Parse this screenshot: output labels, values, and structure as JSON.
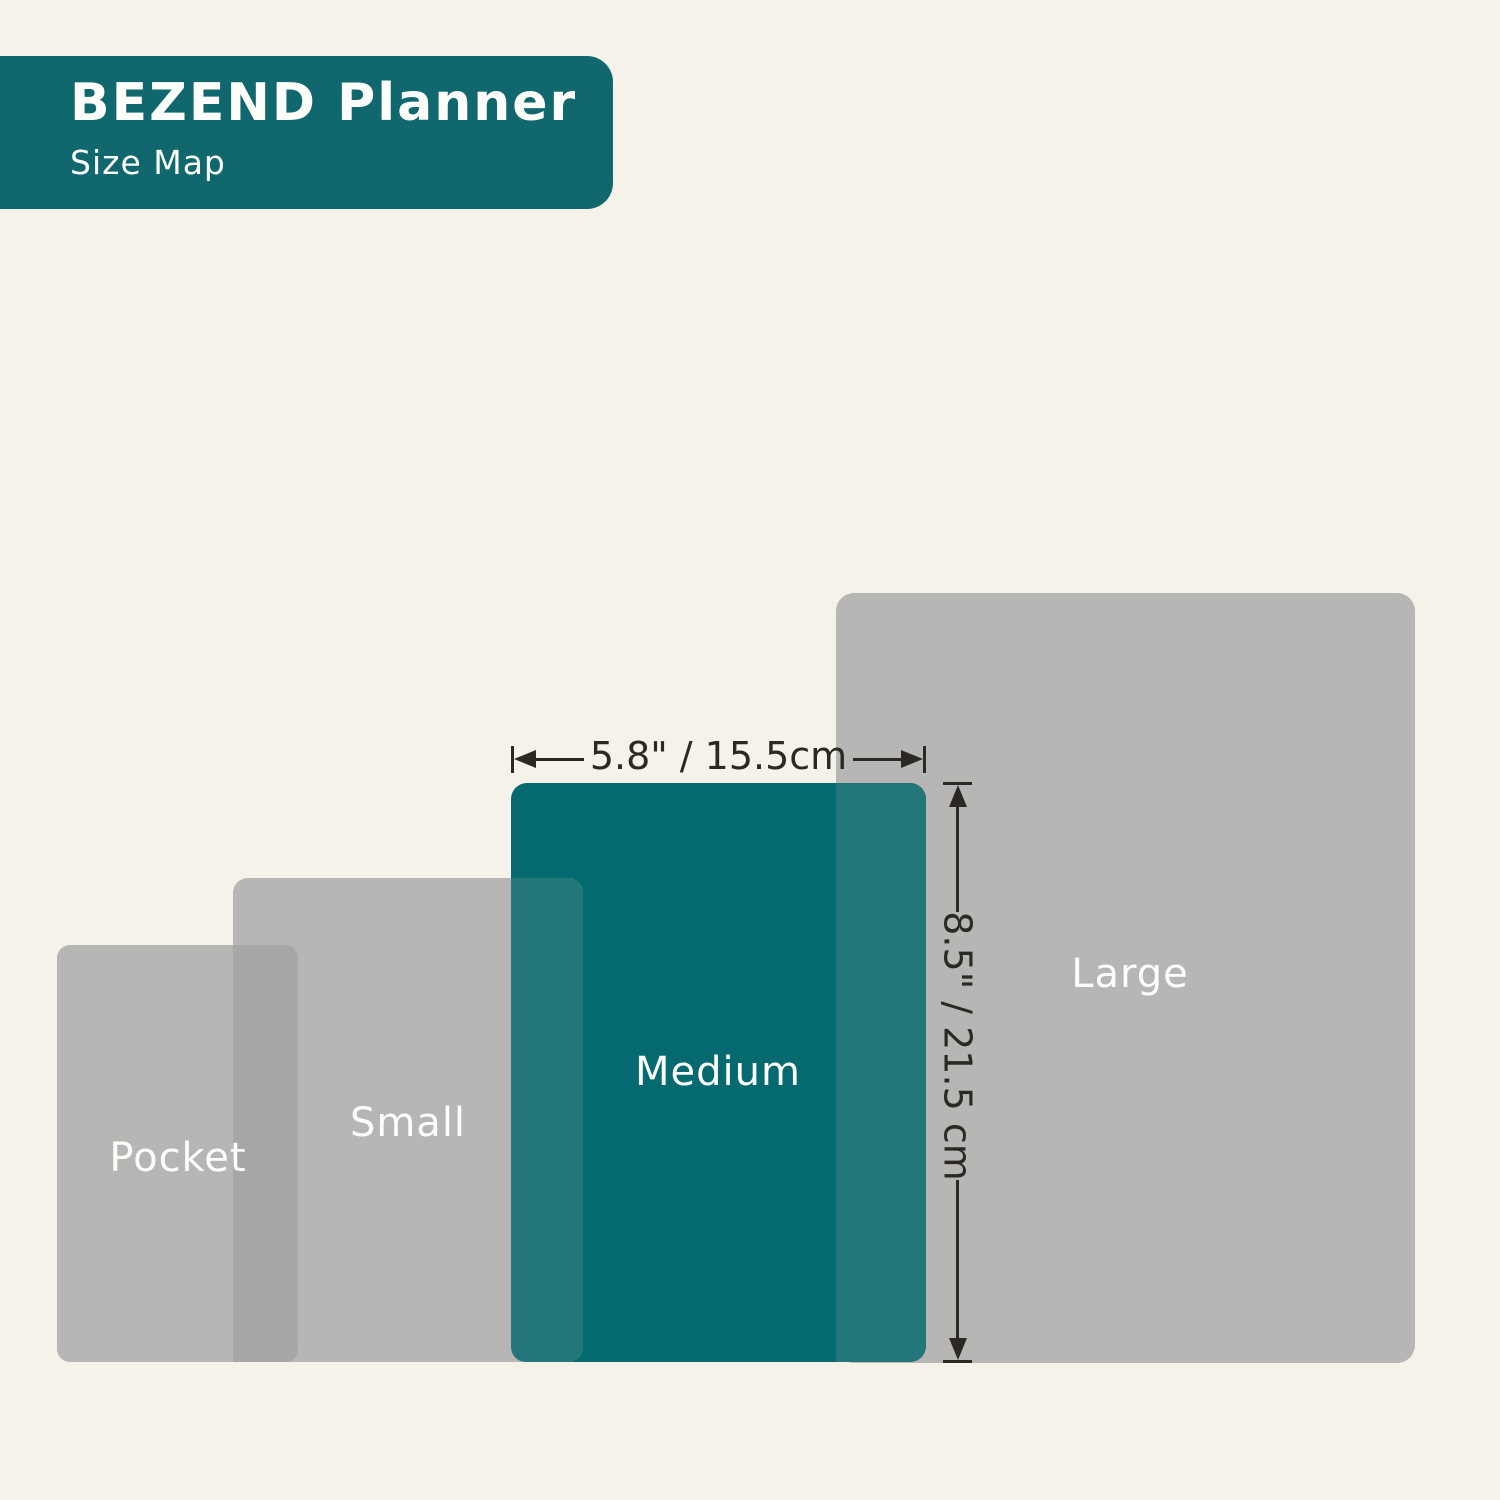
{
  "header": {
    "title": "BEZEND Planner",
    "subtitle": "Size Map"
  },
  "sizes": {
    "pocket": {
      "label": "Pocket"
    },
    "small": {
      "label": "Small"
    },
    "medium": {
      "label": "Medium"
    },
    "large": {
      "label": "Large"
    }
  },
  "dimensions": {
    "medium_width": "5.8\" / 15.5cm",
    "medium_height": "8.5\" / 21.5 cm"
  },
  "colors": {
    "background": "#f5f2e9",
    "header_teal": "#10676d",
    "medium_teal": "#056a70",
    "size_gray": "#b8b6b4",
    "gray_overlap": "#a8a7a5",
    "teal_overlap": "#23777a",
    "dimension_ink": "#2c2925",
    "label_text": "#fdfdfa"
  }
}
